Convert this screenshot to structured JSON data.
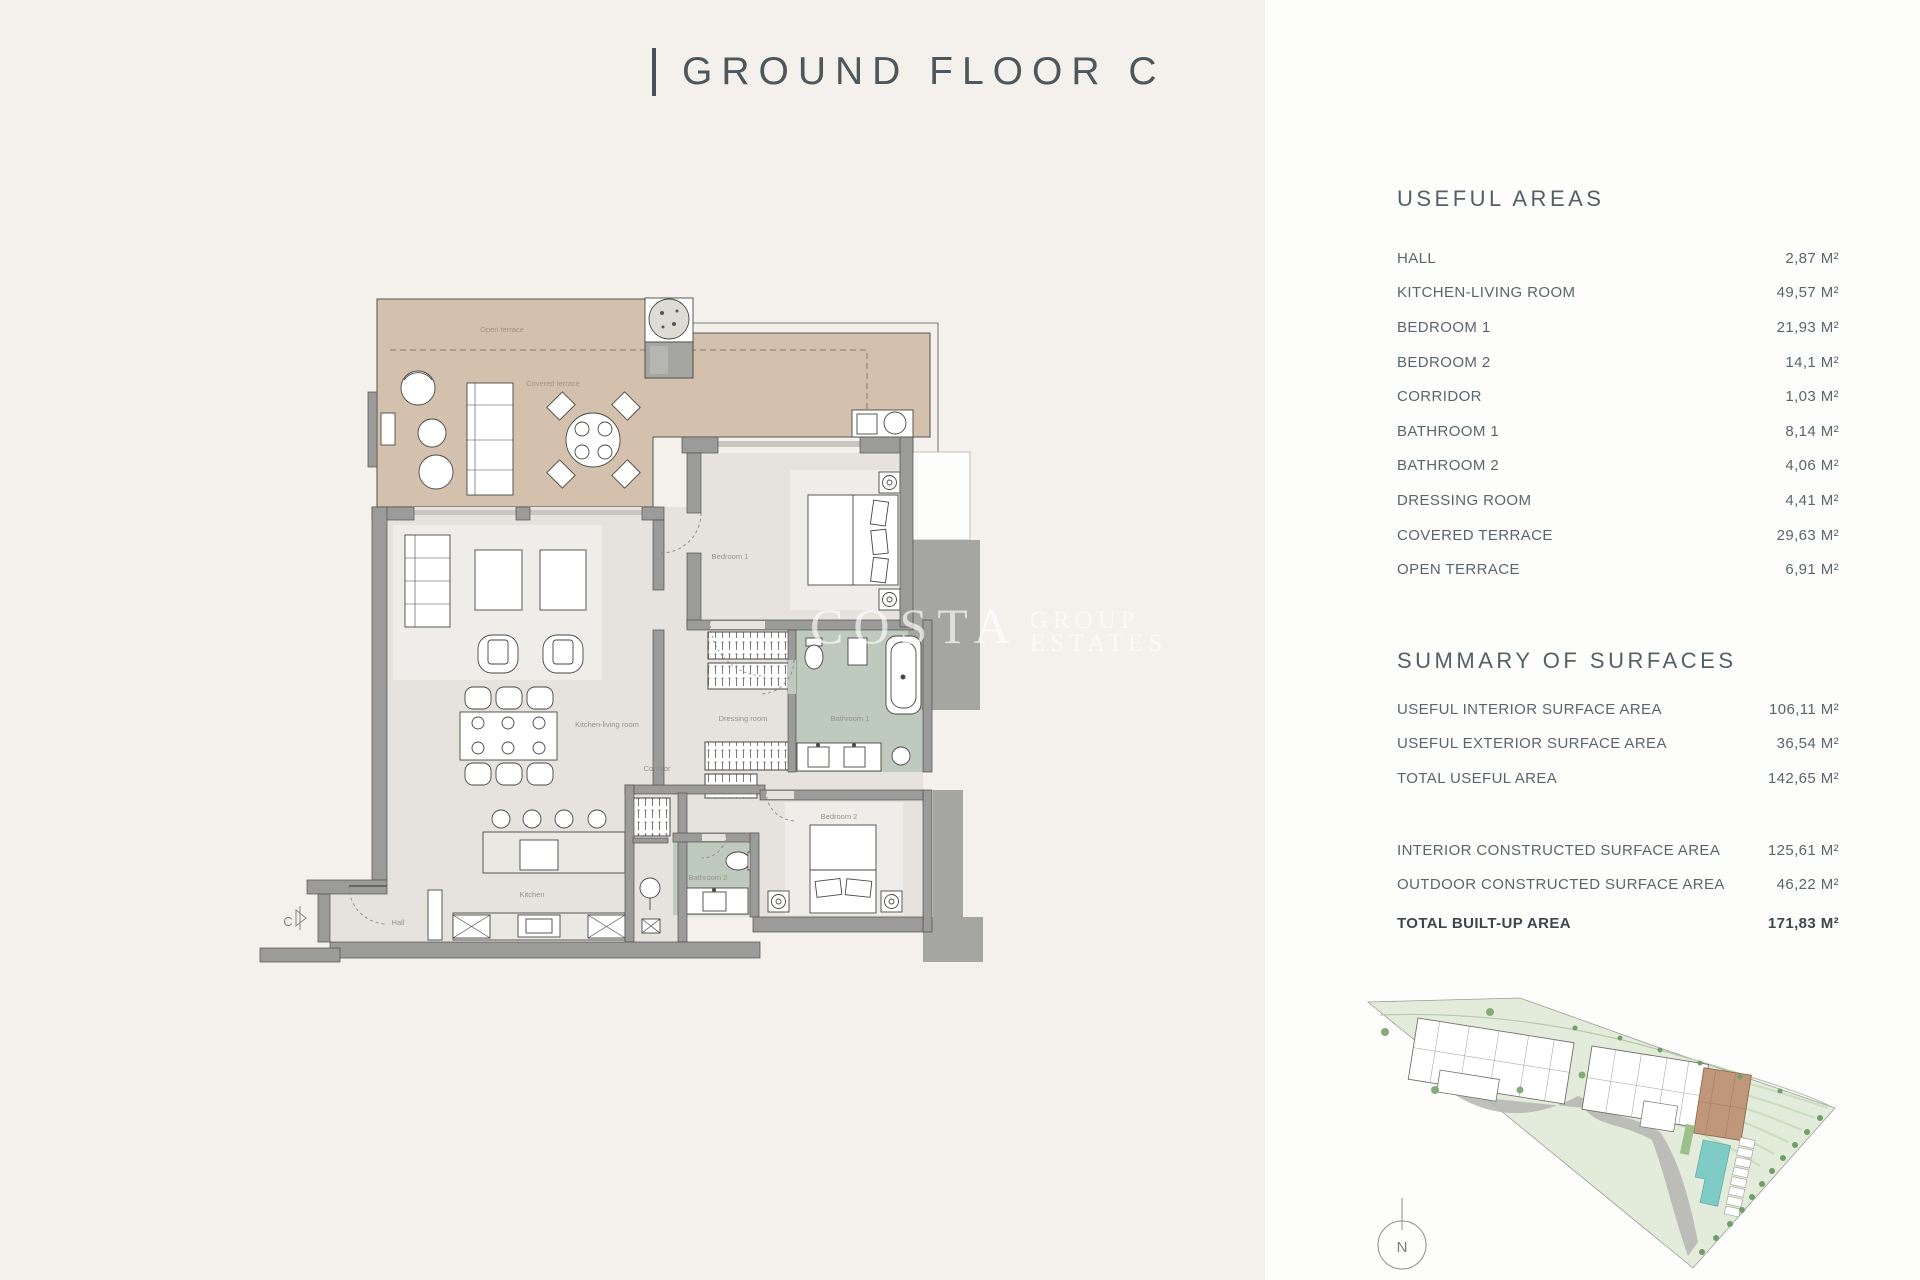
{
  "title": {
    "separator": "|",
    "text": "GROUND FLOOR C"
  },
  "panel": {
    "useful_areas": {
      "heading": "USEFUL AREAS",
      "rows": [
        {
          "label": "HALL",
          "value": "2,87 M²"
        },
        {
          "label": "KITCHEN-LIVING ROOM",
          "value": "49,57 M²"
        },
        {
          "label": "BEDROOM 1",
          "value": "21,93 M²"
        },
        {
          "label": "BEDROOM 2",
          "value": "14,1 M²"
        },
        {
          "label": "CORRIDOR",
          "value": "1,03 M²"
        },
        {
          "label": "BATHROOM 1",
          "value": "8,14 M²"
        },
        {
          "label": "BATHROOM 2",
          "value": "4,06 M²"
        },
        {
          "label": "DRESSING ROOM",
          "value": "4,41 M²"
        },
        {
          "label": "COVERED TERRACE",
          "value": "29,63 M²"
        },
        {
          "label": "OPEN TERRACE",
          "value": "6,91 M²"
        }
      ]
    },
    "summary": {
      "heading": "SUMMARY OF SURFACES",
      "rows_useful": [
        {
          "label": "USEFUL INTERIOR SURFACE AREA",
          "value": "106,11 M²"
        },
        {
          "label": "USEFUL EXTERIOR SURFACE AREA",
          "value": "36,54 M²"
        },
        {
          "label": "TOTAL USEFUL AREA",
          "value": "142,65 M²"
        }
      ],
      "rows_constructed": [
        {
          "label": "INTERIOR CONSTRUCTED SURFACE AREA",
          "value": "125,61 M²"
        },
        {
          "label": "OUTDOOR CONSTRUCTED SURFACE AREA",
          "value": "46,22 M²"
        }
      ],
      "total": {
        "label": "TOTAL BUILT-UP AREA",
        "value": "171,83 M²"
      }
    }
  },
  "floor_plan": {
    "labels": {
      "open_terrace": "Open terrace",
      "covered_terrace": "Covered terrace",
      "kitchen_living_room": "Kitchen-living room",
      "corridor": "Corridor",
      "bedroom_1": "Bedroom 1",
      "dressing_room": "Dressing room",
      "bathroom_1": "Bathroom 1",
      "bedroom_2": "Bedroom 2",
      "bathroom_2": "Bathroom 2",
      "kitchen": "Kitchen",
      "hall": "Hall"
    },
    "entry_marker": "C"
  },
  "site_plan": {
    "compass": "N"
  },
  "watermark": {
    "word": "COSTA",
    "line1": "GROUP",
    "line2": "ESTATES"
  },
  "colors": {
    "background": "#f4f1ec",
    "panel": "#fdfdfc",
    "terrace": "#d3c1ae",
    "interior": "#e6e3de",
    "bathroom": "#becabd",
    "wall": "#9b9b99",
    "accent_text": "#4d575c",
    "site_green": "#e2ebd9",
    "pool": "#7fcbc6",
    "highlight_unit": "#c0977b"
  }
}
